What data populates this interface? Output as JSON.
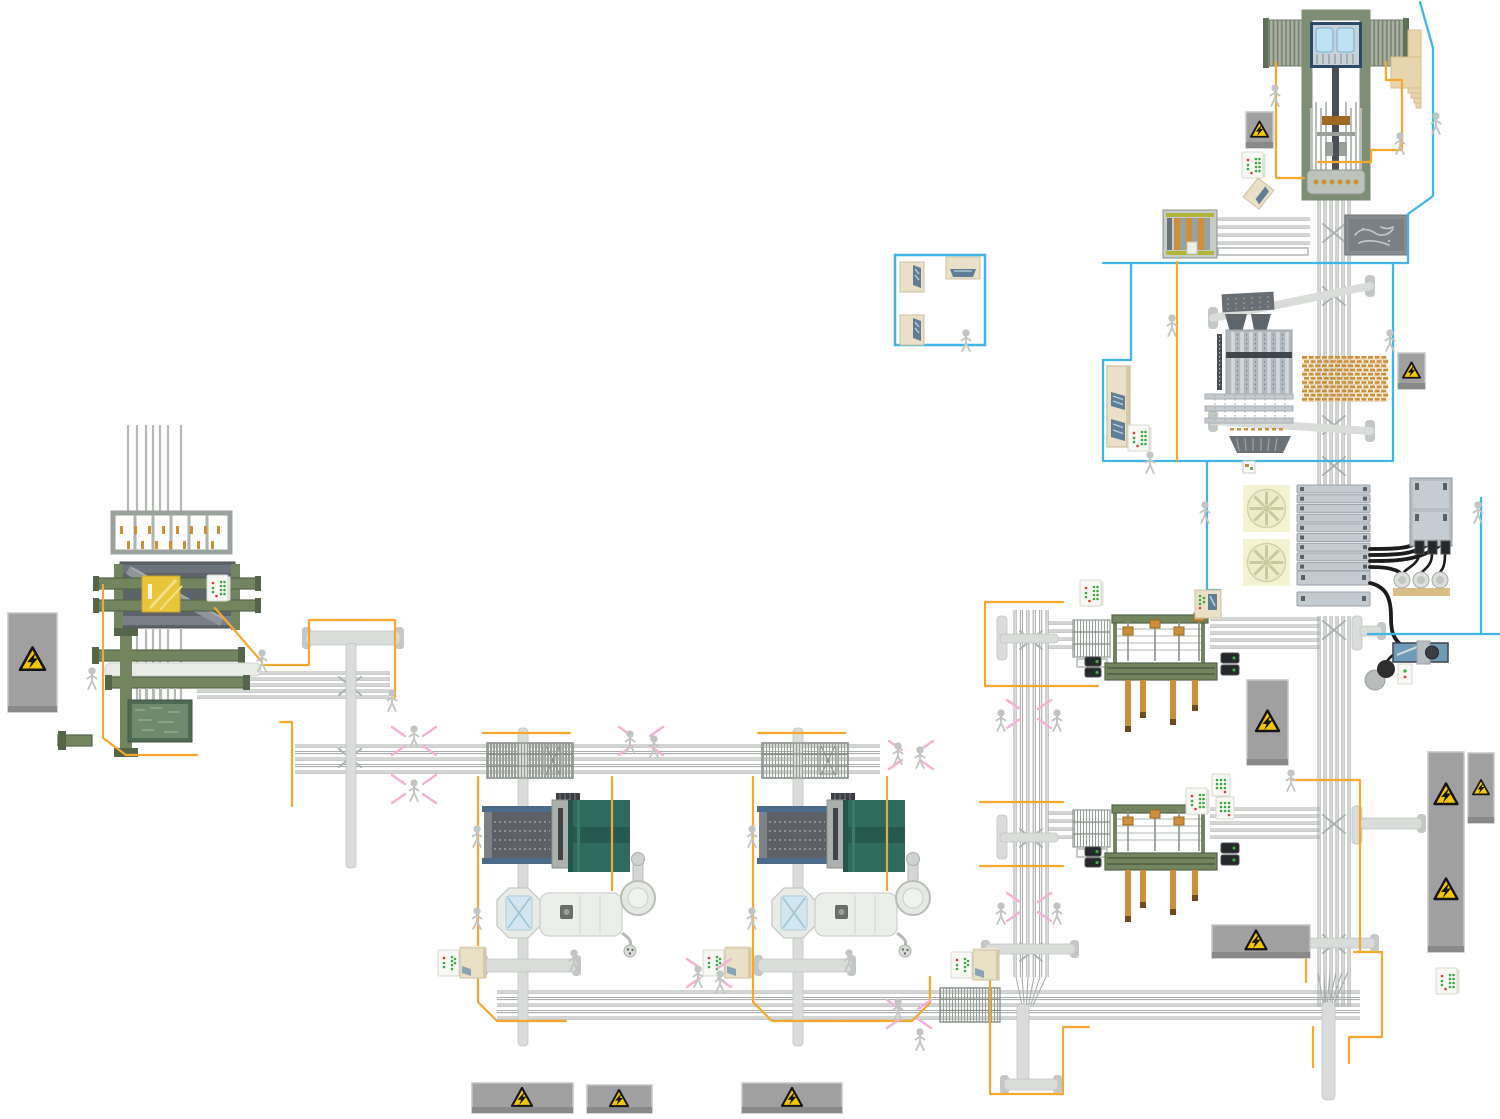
{
  "scene": {
    "title": "sawmill-production-line-top-view-illustration",
    "canvas": {
      "width": 1500,
      "height": 1119
    }
  },
  "palette": {
    "blue": "#41b6e6",
    "orange": "#f6a82e",
    "pink": "#f3b1d6",
    "strand": "#a9aeaa",
    "belt": "#d9dcd9",
    "beltCap": "#c3c8c4",
    "sage": "#7d8e74",
    "sageDark": "#5f7058",
    "green": "#73855f",
    "greenDark": "#546549",
    "navy": "#2c4a68",
    "trough": "#bfe2f2",
    "troughEdge": "#86b8d2",
    "yg": "#b2b43c",
    "wood": "#cf8f3a",
    "woodDark": "#9c6a22",
    "teal": "#2e6b5e",
    "tealDark": "#265a4e",
    "bluerail": "#4a6b8a",
    "yellow": "#e9c53b",
    "beige": "#e9e0c6",
    "beigeDark": "#cdc0a0",
    "screen": "#5f7d95",
    "tan": "#e8d5ae",
    "tanDark": "#d9bd85",
    "vessel": "#eceeea",
    "person": "#c2c6c2",
    "warnY": "#f4c600",
    "panelG": "#a0a0a0",
    "rackF": "#c3cad0",
    "rackE": "#99a1a8",
    "fanBg": "#f3f3d2",
    "fanC": "#ededc8",
    "fanL": "#c9c9a0",
    "ledG": "#3aa93f",
    "ledR": "#d23b2f",
    "cable": "#1c1c1c"
  },
  "machines": {
    "top_gantry": {
      "x": 1263,
      "y": 12,
      "label": "log-crane-gantry"
    },
    "stairs": {
      "x": 1385,
      "y": 22,
      "label": "access-stairs"
    },
    "feeder": {
      "x": 1163,
      "y": 210,
      "label": "feeder-module"
    },
    "sketch_panel": {
      "x": 1345,
      "y": 215,
      "label": "status-board"
    },
    "sorter": {
      "x": 1205,
      "y": 290,
      "label": "vertical-sorter-line"
    },
    "rack": {
      "x": 1297,
      "y": 485,
      "label": "sorting-bin-rack"
    },
    "motor_panel": {
      "x": 1365,
      "y": 475,
      "label": "drive-cabinet-with-pumps"
    },
    "blue_machine": {
      "x": 1393,
      "y": 641,
      "label": "saw-sharpener-unit"
    },
    "tall_cabinet": {
      "x": 1107,
      "y": 366,
      "label": "control-cabinet"
    },
    "left_complex": {
      "x": 90,
      "y": 420,
      "label": "log-intake-machine"
    },
    "control_room": {
      "x": 895,
      "y": 255,
      "label": "control-room"
    },
    "trimmer1": {
      "x": 1073,
      "y": 593,
      "label": "board-trimmer-upper"
    },
    "trimmer2": {
      "x": 1073,
      "y": 783,
      "label": "board-trimmer-lower"
    },
    "drum1": {
      "x": 460,
      "y": 730,
      "label": "debarker-drum-line-left"
    },
    "drum2": {
      "x": 735,
      "y": 730,
      "label": "debarker-drum-line-right"
    }
  },
  "rack": {
    "w": 73,
    "rows": 9,
    "rh": 8,
    "step": 9.7,
    "big": [
      [
        86,
        14
      ],
      [
        107,
        14
      ]
    ]
  },
  "lumber_stack": {
    "x": 1302,
    "y": 356,
    "cols": 13,
    "rows": 11,
    "dw": 5,
    "dh": 2.6,
    "gx": 6.6,
    "gy": 4.2
  },
  "fans": [
    [
      1243,
      485
    ],
    [
      1243,
      539
    ]
  ],
  "conveyors": {
    "h": [
      [
        197,
        672,
        193,
        5,
        6
      ],
      [
        295,
        745,
        585,
        5,
        6.5
      ],
      [
        497,
        991,
        863,
        5,
        6.5
      ],
      [
        1210,
        618,
        110,
        5,
        7
      ],
      [
        1210,
        808,
        110,
        5,
        7
      ],
      [
        1048,
        622,
        26,
        4,
        8
      ],
      [
        1048,
        812,
        26,
        4,
        8
      ],
      [
        1213,
        218,
        97,
        4,
        8
      ]
    ],
    "v": [
      [
        1014,
        610,
        367,
        6,
        6.4
      ],
      [
        1318,
        194,
        291,
        6,
        6
      ],
      [
        1318,
        616,
        391,
        6,
        6
      ]
    ],
    "hatch": [
      [
        487,
        743,
        86,
        35
      ],
      [
        762,
        743,
        86,
        35
      ],
      [
        940,
        988,
        60,
        34
      ]
    ],
    "funnels": [
      [
        1016,
        977,
        30,
        28,
        1022,
        11
      ],
      [
        1318,
        972,
        30,
        31,
        1323,
        11
      ]
    ],
    "bars": [
      [
        306,
        631,
        94,
        14,
        1
      ],
      [
        346,
        643,
        10,
        225,
        0
      ],
      [
        997,
        616,
        10,
        44,
        0
      ],
      [
        1000,
        634,
        58,
        9,
        0
      ],
      [
        997,
        815,
        10,
        44,
        0
      ],
      [
        1000,
        833,
        58,
        9,
        0
      ],
      [
        985,
        944,
        90,
        10,
        1
      ],
      [
        1017,
        1004,
        12,
        78,
        0
      ],
      [
        1004,
        1079,
        54,
        11,
        1
      ],
      [
        1290,
        938,
        85,
        10,
        1
      ],
      [
        1322,
        1002,
        13,
        98,
        0
      ],
      [
        518,
        728,
        10,
        318,
        0
      ],
      [
        793,
        728,
        10,
        318,
        0
      ],
      [
        483,
        959,
        94,
        13,
        1
      ],
      [
        758,
        959,
        94,
        13,
        1
      ],
      [
        1352,
        616,
        10,
        34,
        0
      ],
      [
        1360,
        626,
        22,
        10,
        3
      ],
      [
        1352,
        806,
        10,
        38,
        0
      ],
      [
        1360,
        818,
        62,
        11,
        3
      ]
    ],
    "diagonals": [
      [
        1213,
        318,
        1370,
        286
      ],
      [
        1213,
        421,
        1370,
        431
      ]
    ],
    "frames": [
      [
        1218,
        248,
        90,
        7
      ],
      [
        544,
        747,
        18,
        27
      ],
      [
        819,
        747,
        18,
        27
      ]
    ],
    "xlines": [
      [
        546,
        746,
        560,
        775
      ],
      [
        560,
        746,
        546,
        775
      ],
      [
        821,
        746,
        835,
        775
      ],
      [
        835,
        746,
        821,
        775
      ]
    ],
    "chevrons": [
      [
        350,
        686
      ],
      [
        350,
        758
      ],
      [
        1031,
        640
      ],
      [
        1031,
        838
      ],
      [
        1031,
        952
      ],
      [
        1334,
        233
      ],
      [
        1334,
        296
      ],
      [
        1334,
        425
      ],
      [
        1334,
        466
      ],
      [
        1334,
        630
      ],
      [
        1334,
        824
      ],
      [
        1334,
        944
      ]
    ]
  },
  "paths": {
    "orange": [
      "1276,62 1276,178 1304,178",
      "1386,62 1386,80 1402,80 1402,150 1371,150 1371,162 1318,162",
      "1177,262 1177,460",
      "1063,602 985,602 985,686 1098,686",
      "980,802 1063,802",
      "980,866 1063,866",
      "1292,780 1360,780 1360,950",
      "1354,952 1382,952 1382,1037 1349,1037 1349,1063",
      "990,973 990,1094 1063,1094 1063,1027 1089,1027",
      "1306,955 1306,982",
      "1313,1027 1313,1067",
      "103,585 103,738 126,755 197,755",
      "215,608 262,662",
      "262,665 309,665 309,620 395,620 395,697",
      "280,722 292,722 292,806",
      "483,733 570,733",
      "478,777 478,1002 497,1021 566,1021",
      "612,777 612,890",
      "758,733 845,733",
      "753,777 753,1002 772,1021 841,1021",
      "887,777 887,890",
      "841,1021 912,1021 930,1003 930,977"
    ],
    "blue": [
      "1420,2 1433,48 1433,196 1408,214 1408,263",
      "1103,263 1408,263",
      "1131,263 1131,360 1103,360 1103,461",
      "1103,461 1393,461",
      "1393,263 1393,461",
      "1481,498 1481,634",
      "1368,634 1500,634",
      "1207,461 1207,590 1220,590 1220,600"
    ]
  },
  "warning_signs": [
    {
      "x": 8,
      "y": 613,
      "w": 49,
      "h": 99,
      "tris": [
        [
          32.5,
          660,
          26
        ]
      ]
    },
    {
      "x": 1246,
      "y": 112,
      "w": 27,
      "h": 36,
      "tris": [
        [
          1259.5,
          130,
          18
        ]
      ]
    },
    {
      "x": 1398,
      "y": 353,
      "w": 27,
      "h": 36,
      "tris": [
        [
          1411.5,
          371,
          18
        ]
      ]
    },
    {
      "x": 1247,
      "y": 680,
      "w": 41,
      "h": 85,
      "tris": [
        [
          1267.5,
          722,
          24
        ]
      ]
    },
    {
      "x": 1212,
      "y": 925,
      "w": 98,
      "h": 33,
      "tris": [
        [
          1256,
          941,
          22
        ]
      ]
    },
    {
      "x": 1428,
      "y": 752,
      "w": 36,
      "h": 200,
      "tris": [
        [
          1446,
          795,
          24
        ],
        [
          1446,
          890,
          24
        ]
      ]
    },
    {
      "x": 1468,
      "y": 753,
      "w": 26,
      "h": 70,
      "tris": [
        [
          1481,
          788,
          17
        ]
      ]
    },
    {
      "x": 472,
      "y": 1083,
      "w": 101,
      "h": 30,
      "tris": [
        [
          522,
          1098,
          21
        ]
      ]
    },
    {
      "x": 587,
      "y": 1085,
      "w": 65,
      "h": 28,
      "tris": [
        [
          619,
          1099,
          19
        ]
      ]
    },
    {
      "x": 742,
      "y": 1083,
      "w": 100,
      "h": 30,
      "tris": [
        [
          792,
          1098,
          21
        ]
      ]
    }
  ],
  "control_panels": [
    {
      "type": "led",
      "x": 207,
      "y": 575
    },
    {
      "type": "led",
      "x": 1080,
      "y": 580
    },
    {
      "type": "led",
      "x": 1128,
      "y": 425
    },
    {
      "type": "led",
      "x": 1186,
      "y": 788
    },
    {
      "type": "led",
      "x": 1242,
      "y": 152
    },
    {
      "type": "led",
      "x": 1436,
      "y": 968
    },
    {
      "type": "grid",
      "x": 1212,
      "y": 774
    },
    {
      "type": "grid",
      "x": 1216,
      "y": 797
    },
    {
      "type": "combo",
      "x": 438,
      "y": 948
    },
    {
      "type": "combo",
      "x": 703,
      "y": 948
    },
    {
      "type": "combo",
      "x": 951,
      "y": 950
    },
    {
      "type": "pc",
      "x": 1195,
      "y": 590
    },
    {
      "type": "mini",
      "x": 1243,
      "y": 461
    },
    {
      "type": "cab_tall",
      "x": 900,
      "y": 262
    },
    {
      "type": "cab_tall",
      "x": 900,
      "y": 315
    },
    {
      "type": "cab_wide",
      "x": 946,
      "y": 257
    },
    {
      "type": "cab_tilt",
      "x": 1258,
      "y": 178
    }
  ],
  "persons": [
    [
      1275,
      85
    ],
    [
      1400,
      133
    ],
    [
      1436,
      113
    ],
    [
      966,
      330
    ],
    [
      1172,
      315
    ],
    [
      1390,
      330
    ],
    [
      1150,
      452
    ],
    [
      1205,
      502
    ],
    [
      1478,
      502
    ],
    [
      92,
      668
    ],
    [
      262,
      650
    ],
    [
      392,
      690
    ],
    [
      414,
      726
    ],
    [
      414,
      780
    ],
    [
      630,
      731
    ],
    [
      654,
      736
    ],
    [
      477,
      826
    ],
    [
      477,
      908
    ],
    [
      574,
      950
    ],
    [
      752,
      826
    ],
    [
      752,
      908
    ],
    [
      849,
      950
    ],
    [
      698,
      966
    ],
    [
      720,
      971
    ],
    [
      898,
      743
    ],
    [
      920,
      747
    ],
    [
      898,
      999
    ],
    [
      920,
      1029
    ],
    [
      1001,
      710
    ],
    [
      1057,
      710
    ],
    [
      1001,
      903
    ],
    [
      1057,
      903
    ],
    [
      1291,
      770
    ]
  ],
  "pink_clusters": [
    [
      414,
      741
    ],
    [
      414,
      789
    ],
    [
      641,
      741
    ],
    [
      709,
      973
    ],
    [
      911,
      755
    ],
    [
      909,
      1014
    ],
    [
      1029,
      714
    ],
    [
      1029,
      907
    ]
  ]
}
